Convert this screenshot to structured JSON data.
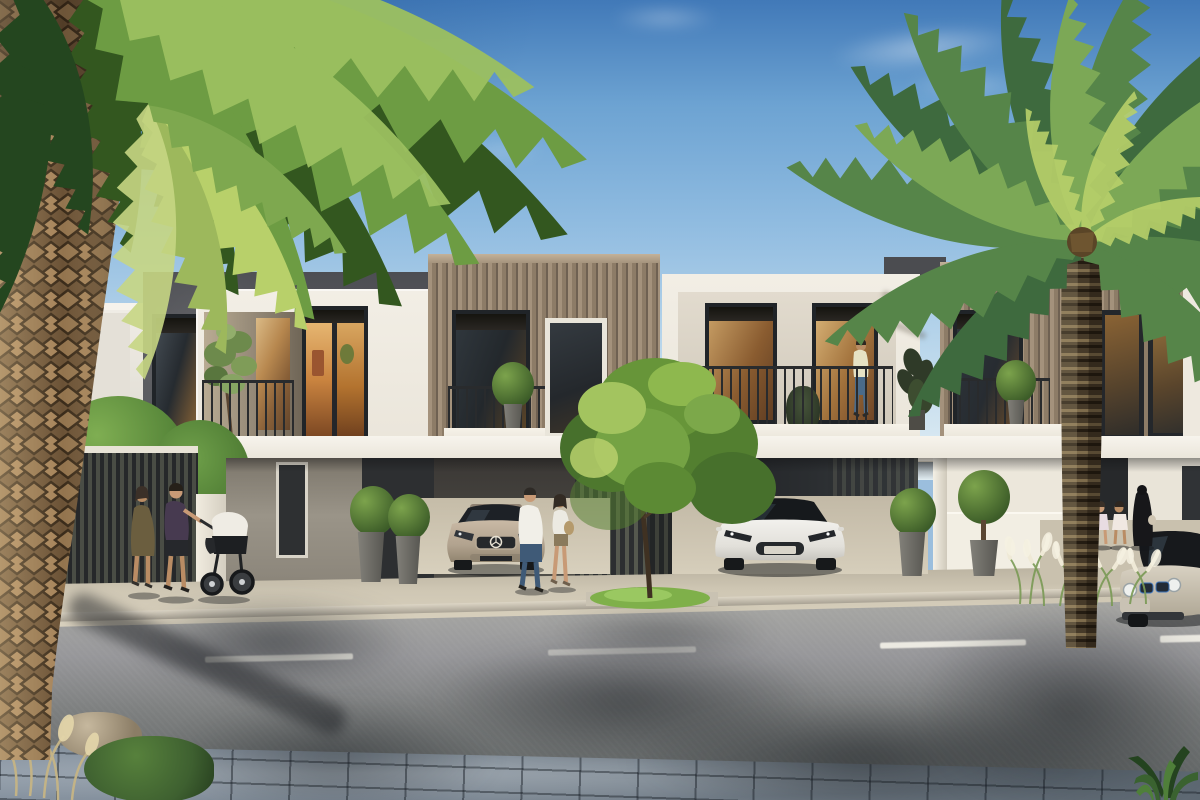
{
  "scene": {
    "label": "modern-townhouse-street-rendering",
    "objects": {
      "vehicles": [
        "mercedes-sedan",
        "tesla-model-s",
        "bmw-i3"
      ],
      "people": [
        "woman-walking",
        "man-pushing-stroller",
        "baby-stroller",
        "couple-walking",
        "man-on-balcony",
        "two-girls",
        "woman-in-abaya"
      ],
      "vegetation": [
        "left-palm-tree",
        "right-palm-tree",
        "street-tree",
        "hedge-trees",
        "potted-topiaries",
        "white-plume-grasses",
        "pampas-grass",
        "foreground-shrub"
      ],
      "architecture": [
        "dark-concrete-unit",
        "white-frame-unit",
        "bronze-clad-units",
        "portal-balcony-unit",
        "carport-canopy",
        "slat-fence",
        "garage-recesses"
      ],
      "street": [
        "asphalt-road",
        "lane-dashes",
        "sidewalk-pavers",
        "foreground-pavers",
        "rocks"
      ]
    }
  },
  "palette": {
    "sky-top": "#4179b8",
    "sky-horizon": "#e4eff4",
    "bronze-light": "#a4927c",
    "bronze-mid": "#8d7c67",
    "bronze-dark": "#6f6152",
    "wall-white": "#f2eee5",
    "window-frame": "#202428",
    "glass-cool": "#262b30",
    "glass-warm": "#c08a4a",
    "railing": "#292b2d",
    "slat-dark": "#2c2e30",
    "slat-gap": "#55584e",
    "pavement": "#cfc7b4",
    "road-top": "#a8a8a4",
    "road-bottom": "#646868",
    "lane": "#eceae2",
    "paver-base": "#7b8691",
    "frond-dark": "#3e6a3e",
    "frond-mid": "#568549",
    "frond-light": "#7ca856",
    "frond-pale": "#b8d06a",
    "left-frond-dark": "#33571f",
    "left-frond-mid": "#6d9c43",
    "left-frond-light": "#9cc060",
    "trunk-scale": "#a5835a",
    "trunk-base": "#6b5236",
    "trunk-crevice": "#3a2b1a",
    "tree-dark": "#47702c",
    "tree-mid": "#679539",
    "tree-light": "#a3c45f",
    "grass-patch": "#7fb04a",
    "mercedes-body": "#b7a794",
    "tesla-body": "#ecebe7",
    "bmw-body": "#cfc7b8",
    "skin": "#c89a76",
    "white-grass": "#efe9d6",
    "pampas": "#d9caa0",
    "rock": "#b3a58e"
  }
}
